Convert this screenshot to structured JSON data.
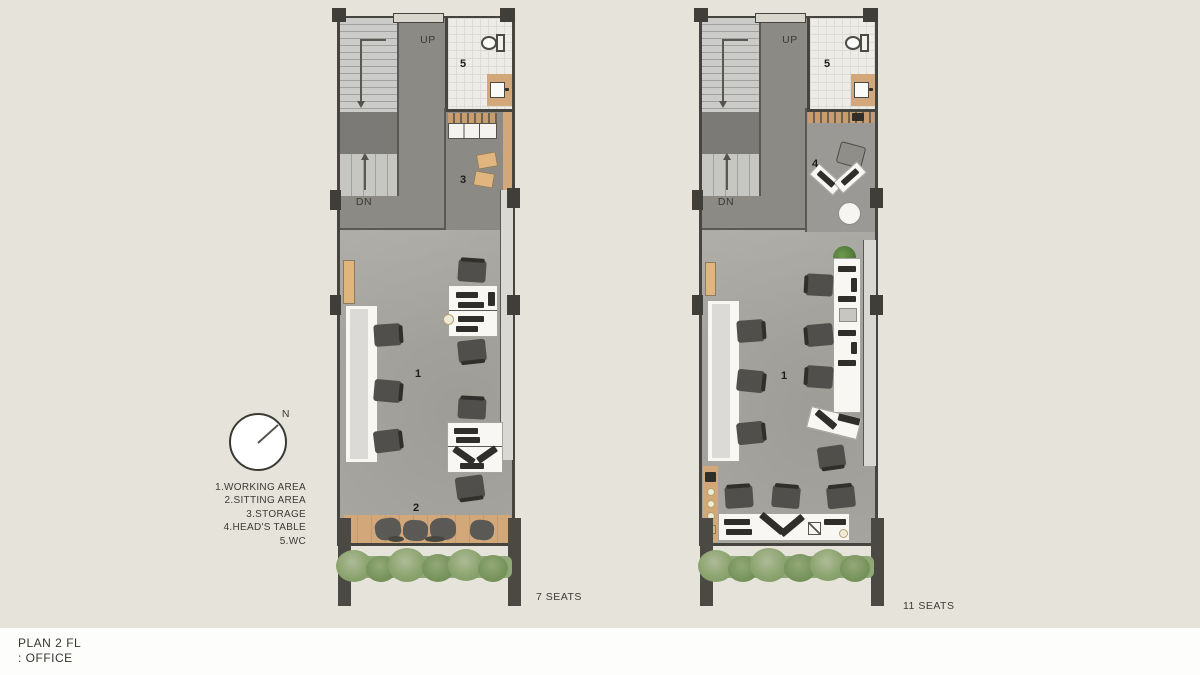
{
  "canvas": {
    "background": "#e6e3da",
    "footer_background": "#fdfdfc"
  },
  "title": {
    "line1": "PLAN 2 FL",
    "line2": ": OFFICE"
  },
  "compass": {
    "north_label": "N"
  },
  "legend": {
    "items": [
      "1.WORKING AREA",
      "2.SITTING AREA",
      "3.STORAGE",
      "4.HEAD'S TABLE",
      "5.WC"
    ]
  },
  "plans": [
    {
      "name": "Option 1",
      "caption": {
        "seats": "7 SEATS",
        "option": "OPTION 1",
        "note": "(SELECTED OPTION)"
      },
      "room_labels": {
        "working": "1",
        "sitting": "2",
        "storage": "3",
        "wc": "5"
      },
      "stairs": {
        "up": "UP",
        "down": "DN"
      }
    },
    {
      "name": "Option 2",
      "caption": {
        "seats": "11 SEATS",
        "option": "OPTION 2"
      },
      "room_labels": {
        "working": "1",
        "head": "4",
        "wc": "5"
      },
      "stairs": {
        "up": "UP",
        "down": "DN"
      }
    }
  ],
  "colors": {
    "wall": "#46443f",
    "floor_main": "#a9a8a2",
    "floor_dark": "#8b8a85",
    "stair": "#cbcbc9",
    "wood": "#d2a87a",
    "desk_white": "#f8f7f4",
    "chair": "#504f4b",
    "greenery": "#8ca46f",
    "wc_floor": "#edece7"
  }
}
